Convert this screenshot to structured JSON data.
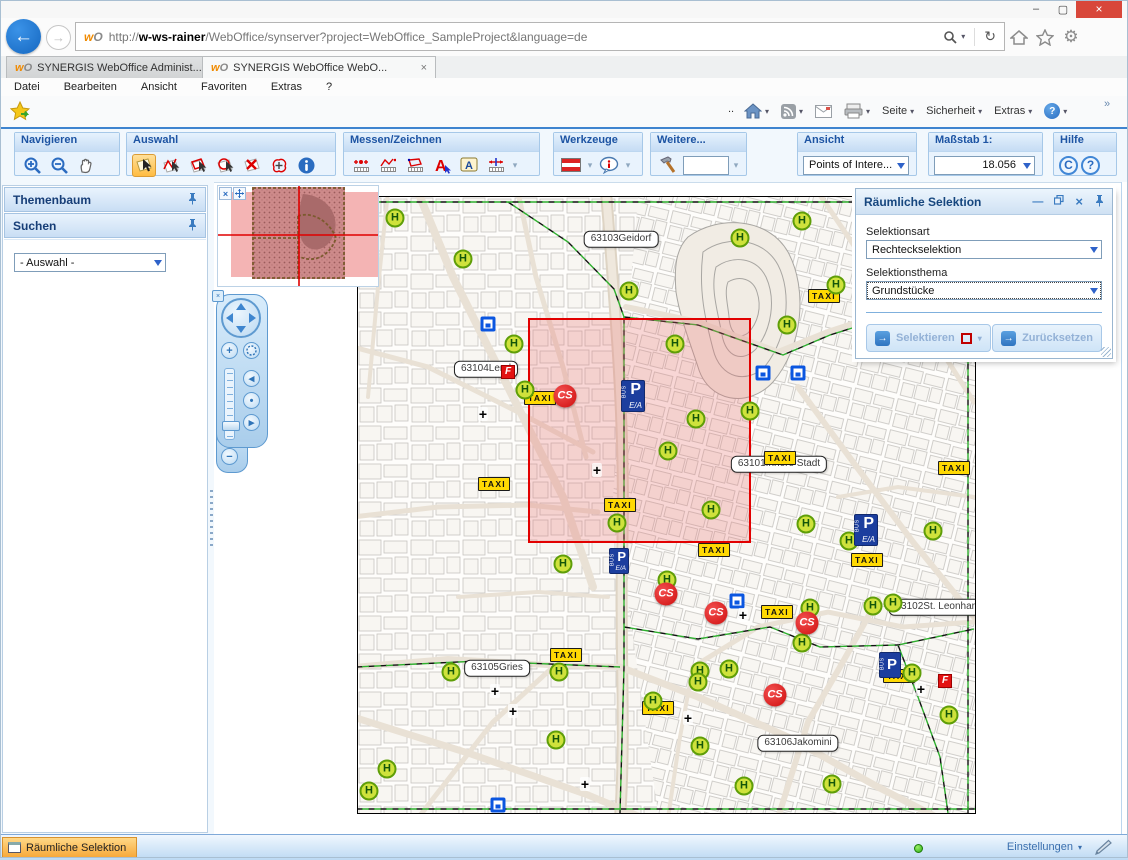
{
  "window": {
    "minimize": "–",
    "maximize": "▢",
    "close": "×"
  },
  "browser": {
    "url_prefix": "http://",
    "url_host": "w-ws-rainer",
    "url_rest": "/WebOffice/synserver?project=WebOffice_SampleProject&language=de",
    "tabs": [
      {
        "title": "SYNERGIS WebOffice Administ..."
      },
      {
        "title": "SYNERGIS WebOffice WebO...",
        "close": "×"
      }
    ],
    "menu": {
      "items": [
        "Datei",
        "Bearbeiten",
        "Ansicht",
        "Favoriten",
        "Extras",
        "?"
      ]
    },
    "command_bar": {
      "dots": "..",
      "seite": "Seite",
      "sicherheit": "Sicherheit",
      "extras": "Extras",
      "chevron": "»"
    }
  },
  "toolbar": {
    "groups": [
      {
        "title": "Navigieren",
        "tools": [
          "zoom-in",
          "zoom-out",
          "pan"
        ]
      },
      {
        "title": "Auswahl",
        "tools": [
          "select-rectangle (active)",
          "select-line",
          "select-polygon",
          "select-circle",
          "clear-selection",
          "select-buffer",
          "identify"
        ]
      },
      {
        "title": "Messen/Zeichnen",
        "tools": [
          "measure-point",
          "measure-line",
          "measure-area",
          "draw-text",
          "draw-label",
          "measure-coordinate",
          "more-dropdown"
        ]
      },
      {
        "title": "Werkzeuge",
        "tools": [
          "flag-tool",
          "maptip-tool"
        ]
      },
      {
        "title": "Weitere...",
        "tools": [
          "hammer-tool",
          "quick-input",
          "more-dropdown"
        ]
      },
      {
        "title": "Ansicht",
        "value": "Points of Intere..."
      },
      {
        "title": "Maßstab 1:",
        "value": "18.056"
      },
      {
        "title": "Hilfe",
        "tools": [
          "copyright",
          "help"
        ],
        "c_label": "C",
        "q_label": "?"
      }
    ]
  },
  "sidebar": {
    "themenbaum_title": "Themenbaum",
    "suchen_title": "Suchen",
    "search_select_value": "- Auswahl -"
  },
  "panel": {
    "title": "Räumliche Selektion",
    "selektionsart_label": "Selektionsart",
    "selektionsart_value": "Rechteckselektion",
    "selektionsthema_label": "Selektionsthema",
    "selektionsthema_value": "Grundstücke",
    "selektieren_label": "Selektieren",
    "zuruecksetzen_label": "Zurücksetzen"
  },
  "statusbar": {
    "item_label": "Räumliche Selektion",
    "settings_label": "Einstellungen"
  },
  "map": {
    "selection_rect": {
      "x": 170,
      "y": 121,
      "w": 223,
      "h": 225
    },
    "labels": [
      {
        "x": 263,
        "y": 42,
        "l1": "63103",
        "l2": "Geidorf"
      },
      {
        "x": 128,
        "y": 172,
        "l1": "63104",
        "l2": "Lend"
      },
      {
        "x": 421,
        "y": 267,
        "l1": "63101",
        "l2": "Innere Stadt"
      },
      {
        "x": 580,
        "y": 410,
        "l1": "63102",
        "l2": "St. Leonhard"
      },
      {
        "x": 139,
        "y": 471,
        "l1": "63105",
        "l2": "Gries"
      },
      {
        "x": 440,
        "y": 546,
        "l1": "63106",
        "l2": "Jakomini"
      }
    ],
    "markers": {
      "taxi": [
        [
          466,
          99
        ],
        [
          596,
          271
        ],
        [
          422,
          261
        ],
        [
          356,
          353
        ],
        [
          509,
          363
        ],
        [
          182,
          201
        ],
        [
          262,
          308
        ],
        [
          208,
          458
        ],
        [
          300,
          511
        ],
        [
          419,
          415
        ],
        [
          541,
          479
        ],
        [
          136,
          287
        ]
      ],
      "h": [
        [
          37,
          21
        ],
        [
          105,
          62
        ],
        [
          271,
          94
        ],
        [
          382,
          41
        ],
        [
          444,
          24
        ],
        [
          478,
          88
        ],
        [
          156,
          147
        ],
        [
          317,
          147
        ],
        [
          429,
          128
        ],
        [
          167,
          193
        ],
        [
          338,
          222
        ],
        [
          310,
          254
        ],
        [
          392,
          214
        ],
        [
          353,
          313
        ],
        [
          259,
          326
        ],
        [
          205,
          367
        ],
        [
          448,
          327
        ],
        [
          491,
          344
        ],
        [
          575,
          334
        ],
        [
          309,
          383
        ],
        [
          515,
          409
        ],
        [
          535,
          406
        ],
        [
          452,
          411
        ],
        [
          444,
          446
        ],
        [
          93,
          475
        ],
        [
          201,
          475
        ],
        [
          342,
          474
        ],
        [
          340,
          485
        ],
        [
          371,
          472
        ],
        [
          295,
          504
        ],
        [
          198,
          543
        ],
        [
          342,
          549
        ],
        [
          554,
          476
        ],
        [
          591,
          518
        ],
        [
          474,
          587
        ],
        [
          386,
          589
        ],
        [
          29,
          572
        ],
        [
          11,
          594
        ]
      ],
      "p_ea": [
        [
          275,
          199
        ],
        [
          508,
          301
        ]
      ],
      "p_ea_sm": [
        [
          261,
          300
        ]
      ],
      "p_bus": [
        [
          532,
          378
        ]
      ],
      "bsq": [
        [
          130,
          127
        ],
        [
          405,
          176
        ],
        [
          440,
          176
        ],
        [
          379,
          404
        ],
        [
          140,
          608
        ]
      ],
      "f": [
        [
          150,
          175
        ],
        [
          587,
          484
        ]
      ],
      "cross": [
        [
          125,
          217
        ],
        [
          239,
          273
        ],
        [
          137,
          494
        ],
        [
          155,
          514
        ],
        [
          330,
          521
        ],
        [
          227,
          587
        ],
        [
          385,
          418
        ],
        [
          563,
          492
        ]
      ],
      "cs": [
        [
          207,
          199
        ],
        [
          308,
          397
        ],
        [
          358,
          416
        ],
        [
          449,
          426
        ],
        [
          417,
          498
        ]
      ]
    },
    "marker_text": {
      "h": "H",
      "taxi": "TAXI",
      "cs": "CS",
      "f": "F",
      "p": "P",
      "p_bus": "BUS",
      "p_ea": "E/A",
      "cross": "+"
    }
  }
}
